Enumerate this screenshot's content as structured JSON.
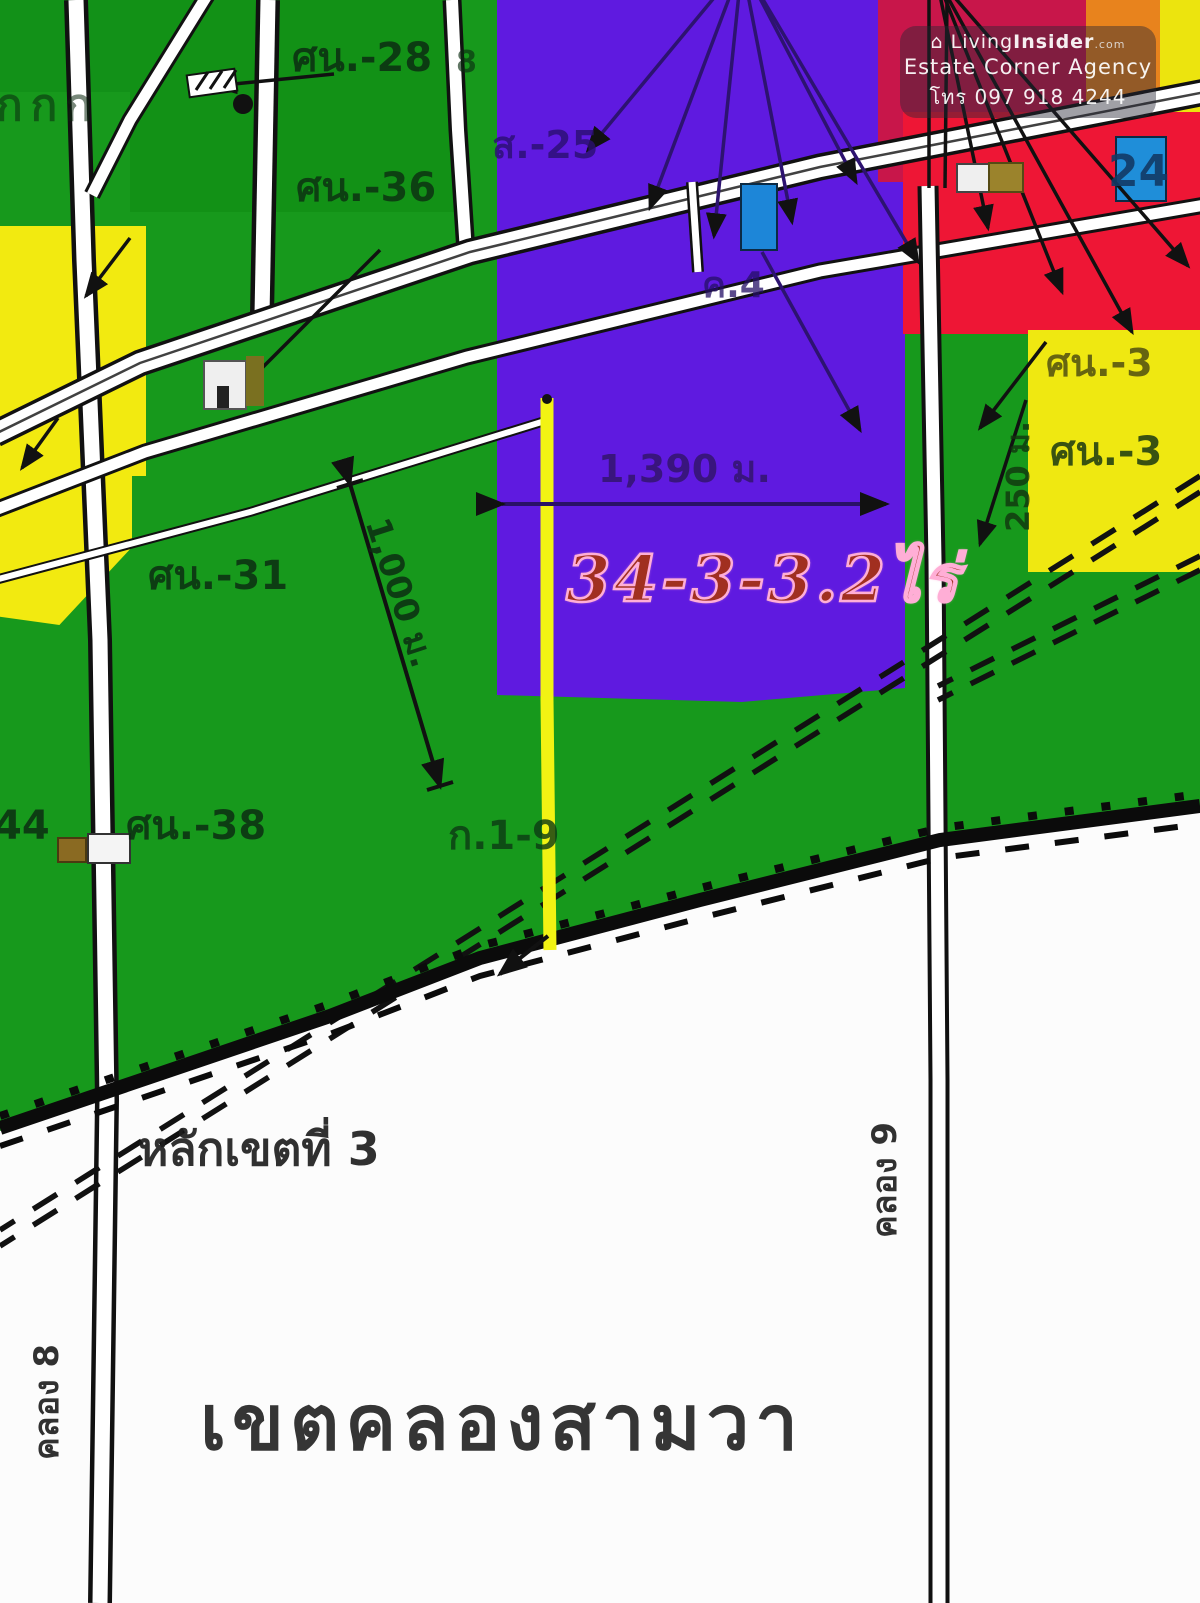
{
  "watermark": {
    "brand_icon": "⌂",
    "brand_prefix": "Living",
    "brand_suffix": "Insider",
    "brand_tld": ".com",
    "agency": "Estate Corner Agency",
    "phone": "โทร 097 918 4244"
  },
  "plot": {
    "area_label": "34-3-3.2ไร่",
    "zone_color": "#5f1ae0",
    "highlight_line_color": "#f2f313"
  },
  "colors": {
    "green_zone": "#17991c",
    "purple_zone": "#5f1ae0",
    "yellow_zone": "#f2ea10",
    "yellow_highlight": "#f2f313",
    "crimson_zone": "#c8164a",
    "red_zone": "#ee1635",
    "orange_zone": "#e8831d",
    "blue_zone": "#1f8ed9",
    "white_area": "#fcfcfc",
    "road_white": "#ffffff",
    "line_black": "#111111",
    "plot_text_red": "#a12f20",
    "plot_text_outline": "#ffaed6"
  },
  "labels": [
    {
      "name": "label-kkk",
      "text": "กกก",
      "x": -4,
      "y": 84,
      "size": 44,
      "color": "#0a280f",
      "opacity": 0.55,
      "spacing": 8
    },
    {
      "name": "label-sn-28",
      "text": "ศน.-28",
      "x": 292,
      "y": 38,
      "size": 40,
      "color": "#0c2d12",
      "opacity": 0.85
    },
    {
      "name": "label-sn-36",
      "text": "ศน.-36",
      "x": 296,
      "y": 168,
      "size": 40,
      "color": "#0c2d12",
      "opacity": 0.8
    },
    {
      "name": "label-8",
      "text": "8",
      "x": 456,
      "y": 48,
      "size": 30,
      "color": "#0c2d12",
      "opacity": 0.65
    },
    {
      "name": "label-s-25",
      "text": "ส.-25",
      "x": 492,
      "y": 126,
      "size": 38,
      "color": "#2a1070",
      "opacity": 0.8
    },
    {
      "name": "label-k-4",
      "text": "ค.4",
      "x": 702,
      "y": 268,
      "size": 36,
      "color": "#251066",
      "opacity": 0.75
    },
    {
      "name": "label-24",
      "text": "24",
      "x": 1108,
      "y": 150,
      "size": 44,
      "color": "#123a66",
      "opacity": 0.9
    },
    {
      "name": "label-1390-m",
      "text": "1,390 ม.",
      "x": 598,
      "y": 450,
      "size": 38,
      "color": "#33156e",
      "opacity": 0.85
    },
    {
      "name": "label-sn-31",
      "text": "ศน.-31",
      "x": 148,
      "y": 556,
      "size": 40,
      "color": "#0c2d12",
      "opacity": 0.85
    },
    {
      "name": "label-1000-m",
      "text": "1,000 ม.",
      "x": 392,
      "y": 514,
      "size": 34,
      "color": "#0c2d12",
      "opacity": 0.85,
      "rotate": 72
    },
    {
      "name": "label-sn-3-yellow",
      "text": "ศน.-3",
      "x": 1046,
      "y": 344,
      "size": 38,
      "color": "#3a3a10",
      "opacity": 0.75
    },
    {
      "name": "label-250-m",
      "text": "250 ม.",
      "x": 1002,
      "y": 532,
      "size": 32,
      "color": "#12350f",
      "opacity": 0.8,
      "rotate": -90
    },
    {
      "name": "label-sn-3-green",
      "text": "ศน.-3",
      "x": 1050,
      "y": 432,
      "size": 40,
      "color": "#0c2d12",
      "opacity": 0.8
    },
    {
      "name": "label-44",
      "text": "44",
      "x": -6,
      "y": 806,
      "size": 40,
      "color": "#0c2d12",
      "opacity": 0.85
    },
    {
      "name": "label-sn-38",
      "text": "ศน.-38",
      "x": 126,
      "y": 806,
      "size": 40,
      "color": "#0c2d12",
      "opacity": 0.85
    },
    {
      "name": "label-k-1-9",
      "text": "ก.1-9",
      "x": 448,
      "y": 816,
      "size": 40,
      "color": "#0c3a14",
      "opacity": 0.8
    },
    {
      "name": "label-border-post",
      "text": "หลักเขตที่ 3",
      "x": 138,
      "y": 1126,
      "size": 46,
      "color": "#1f1f1f",
      "opacity": 0.92
    },
    {
      "name": "label-khlong-8",
      "text": "คลอง 8",
      "x": 30,
      "y": 1460,
      "size": 34,
      "color": "#1c1c1c",
      "opacity": 0.9,
      "rotate": -90
    },
    {
      "name": "label-khlong-9",
      "text": "คลอง 9",
      "x": 868,
      "y": 1238,
      "size": 34,
      "color": "#1c1c1c",
      "opacity": 0.9,
      "rotate": -90
    },
    {
      "name": "label-district",
      "text": "เขตคลองสามวา",
      "x": 200,
      "y": 1385,
      "size": 76,
      "color": "#2b2b2b",
      "opacity": 0.95,
      "spacing": 6,
      "weight": 600
    }
  ]
}
